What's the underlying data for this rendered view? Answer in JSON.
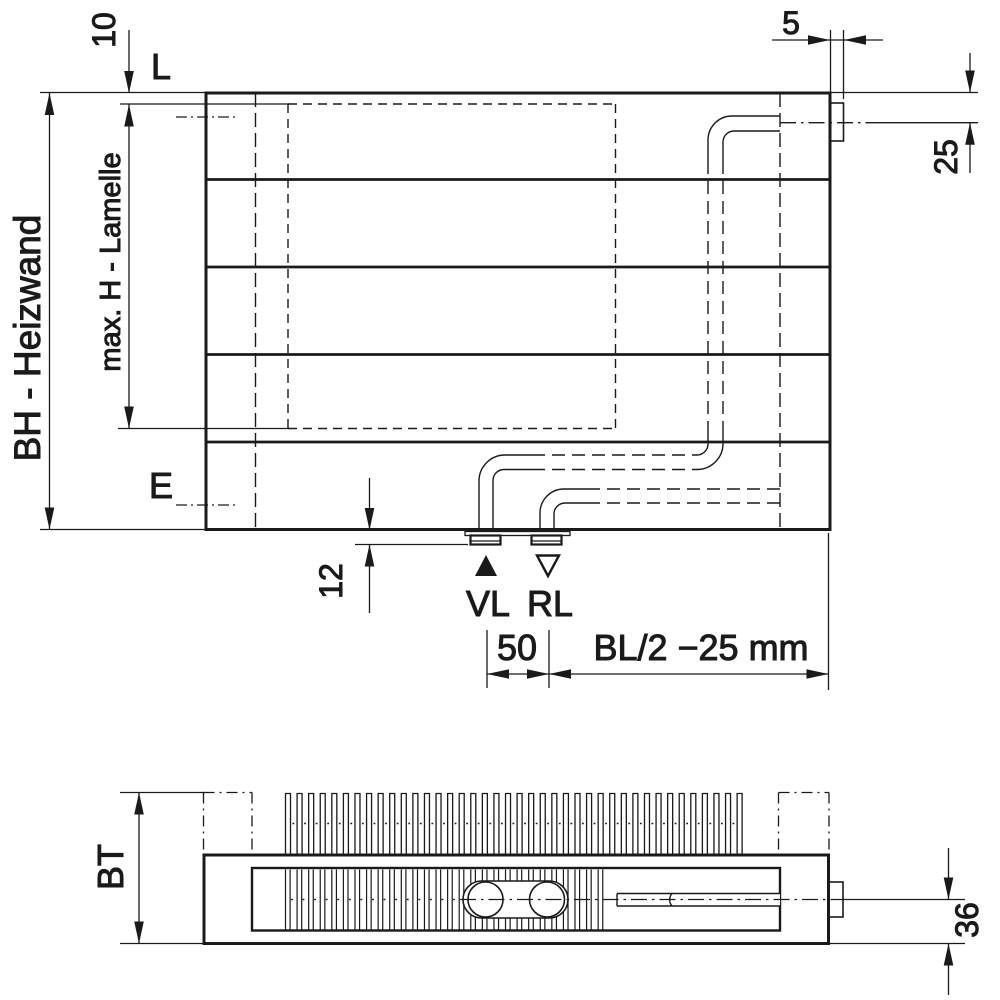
{
  "drawing": {
    "kind": "radiator dimensional technical drawing",
    "colors": {
      "line": "#1a1a1a",
      "background": "#ffffff"
    },
    "front": {
      "top_offset": "10",
      "vent": "L",
      "tab_width": "5",
      "side_offset": "25",
      "build_height": "BH - Heizwand",
      "lamella": "max. H - Lamelle",
      "drain": "E",
      "bottom_clearance": "12",
      "supply": "VL",
      "return": "RL",
      "spacing": "50",
      "position": "BL/2 −25 mm"
    },
    "bottom": {
      "depth": "BT",
      "pipe_offset": "36"
    }
  }
}
